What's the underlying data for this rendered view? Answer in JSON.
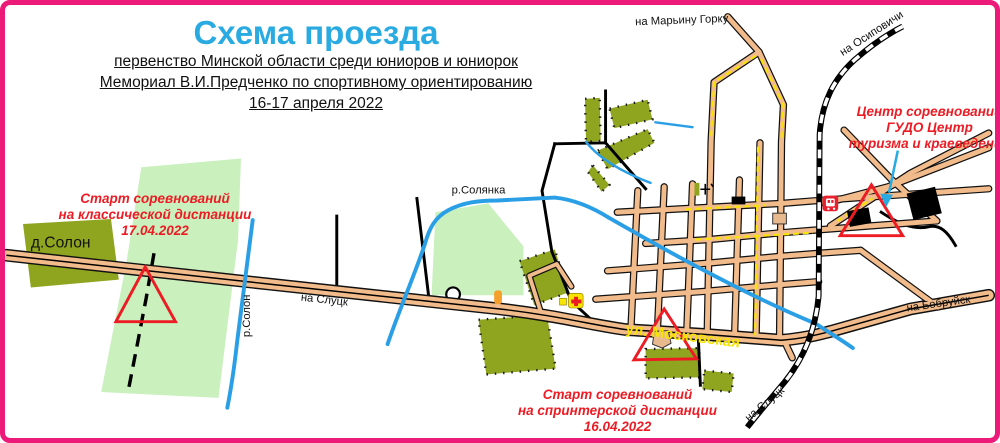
{
  "header": {
    "title": "Схема проезда",
    "subtitle_lines": [
      "первенство Минской области среди юниоров и юниорок",
      "Мемориал В.И.Предченко по спортивному ориентированию",
      "16-17 апреля 2022"
    ]
  },
  "annotations": {
    "start_classic": {
      "lines": [
        "Старт соревнований",
        "на классической дистанции",
        "17.04.2022"
      ]
    },
    "event_center": {
      "lines": [
        "Центр соревнований",
        "ГУДО Центр",
        "туризма и краеведения"
      ]
    },
    "start_sprint": {
      "lines": [
        "Старт соревнований",
        "на спринтерской дистанции",
        "16.04.2022"
      ]
    }
  },
  "map_labels": {
    "to_maryina_gorka": "на Марьину Горку",
    "to_osipovichi": "на Осиповичи",
    "to_bobruisk": "на Бобруйск",
    "to_slutsk_railway": "на Слуцк",
    "to_slutsk_road": "на Слуцк",
    "village_solon": "д.Солон",
    "river_solon": "р.Солон",
    "river_solyanka": "р.Солянка",
    "street_moskovskaya": "ул. Московская"
  },
  "icons": {
    "first_aid": "first-aid-station",
    "railway_station": "railway-station",
    "church": "church-cross",
    "start_triangles": "orienteering-start-triangle",
    "pointer": "blue-pointer-arrow"
  },
  "colors": {
    "border": "#ec1a78",
    "title": "#29abe2",
    "red": "#ed1c24",
    "road": "#f2bb8b",
    "casing": "#111111",
    "olive": "#8fa41f",
    "mint": "#c9f0bd",
    "water": "#2b9fe5",
    "yellow": "#f7e400",
    "ink": "#111111"
  }
}
